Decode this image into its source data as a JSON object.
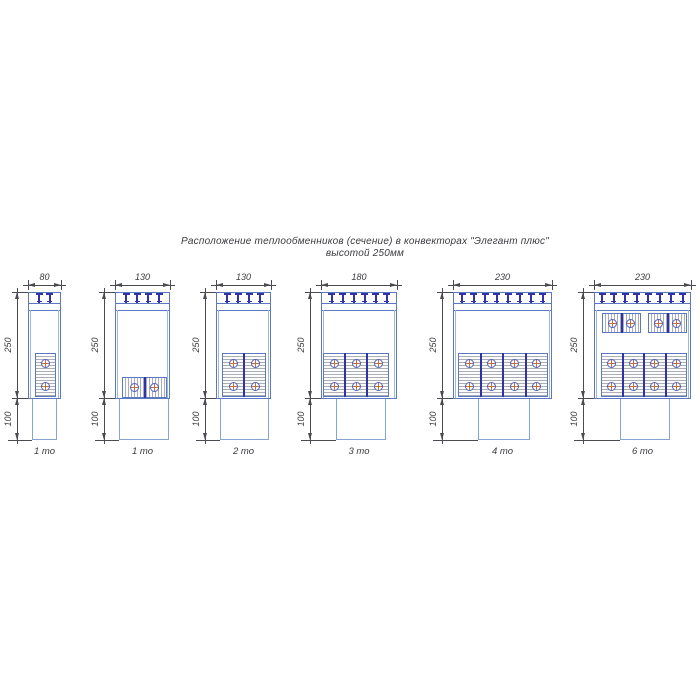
{
  "title": {
    "line1": "Расположение теплообменников (сечение) в конвекторах \"Элегант плюс\"",
    "line2": "высотой 250мм"
  },
  "dimensions": {
    "body_height_mm": "250",
    "duct_height_mm": "100"
  },
  "units": [
    {
      "label": "1 то",
      "width_mm": "80",
      "clips": 2,
      "vertical_exchangers": 1,
      "horizontal_exchangers": 0
    },
    {
      "label": "1 то",
      "width_mm": "130",
      "clips": 4,
      "vertical_exchangers": 0,
      "horizontal_exchangers": 1
    },
    {
      "label": "2 то",
      "width_mm": "130",
      "clips": 4,
      "vertical_exchangers": 2,
      "horizontal_exchangers": 0
    },
    {
      "label": "3 то",
      "width_mm": "180",
      "clips": 6,
      "vertical_exchangers": 3,
      "horizontal_exchangers": 0
    },
    {
      "label": "4 то",
      "width_mm": "230",
      "clips": 8,
      "vertical_exchangers": 4,
      "horizontal_exchangers": 0
    },
    {
      "label": "6 то",
      "width_mm": "230",
      "clips": 8,
      "vertical_exchangers": 4,
      "horizontal_exchangers": 2
    }
  ],
  "colors": {
    "outline_blue": "#5b79c2",
    "duct_blue": "#84a4d2",
    "clip_navy": "#3232a8",
    "hatch_gray": "#a9aeb6",
    "tube_cross_orange": "#c2703d",
    "dimension_gray": "#4a4a50"
  }
}
